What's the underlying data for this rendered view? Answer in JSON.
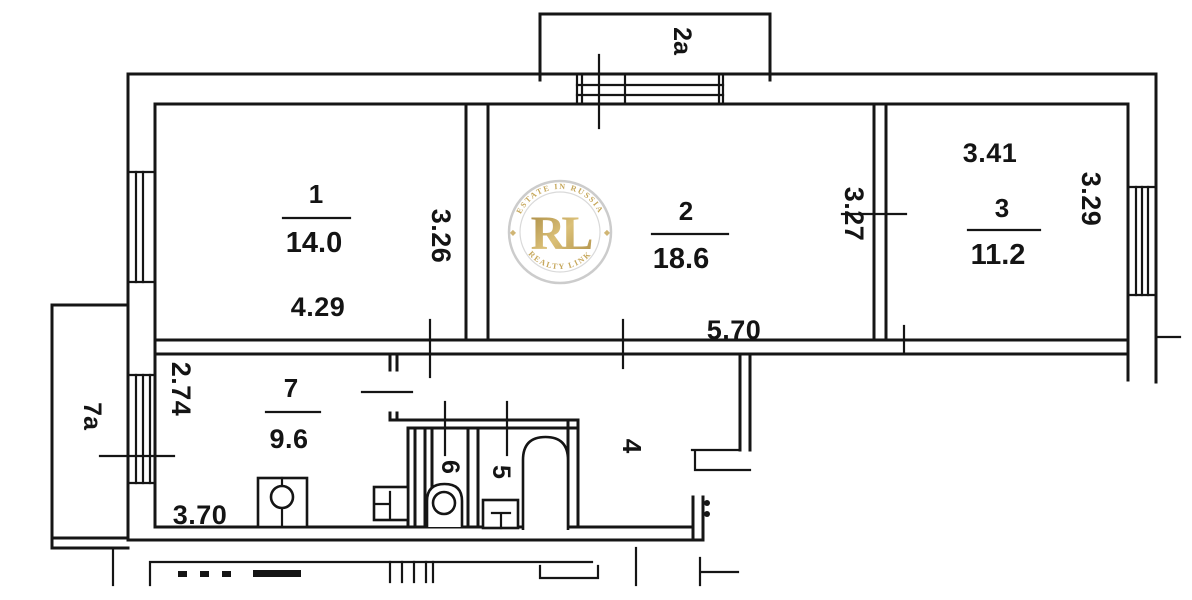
{
  "plan_title": "apartment-floor-plan",
  "rooms": {
    "room1": {
      "number": "1",
      "area": "14.0"
    },
    "room2": {
      "number": "2",
      "area": "18.6"
    },
    "room3": {
      "number": "3",
      "area": "11.2"
    },
    "room4": {
      "number": "4"
    },
    "room5": {
      "number": "5"
    },
    "room6": {
      "number": "6"
    },
    "room7": {
      "number": "7",
      "area": "9.6"
    },
    "balcony_top": {
      "number": "2a"
    },
    "balcony_left": {
      "number": "7a"
    }
  },
  "dimensions": {
    "room1_width": "4.29",
    "room1_depth": "3.26",
    "room2_width": "5.70",
    "room2_depth": "3.27",
    "room3_width": "3.41",
    "room3_depth": "3.29",
    "room7_width": "3.70",
    "room7_depth": "2.74"
  },
  "watermark": {
    "initials": "RL",
    "arc_top": "ESTATE IN RUSSIA",
    "arc_bottom": "REALTY LINK",
    "gold": "#b3913f",
    "ring": "#c9c9c9"
  },
  "colors": {
    "line": "#151515",
    "background": "#ffffff"
  }
}
